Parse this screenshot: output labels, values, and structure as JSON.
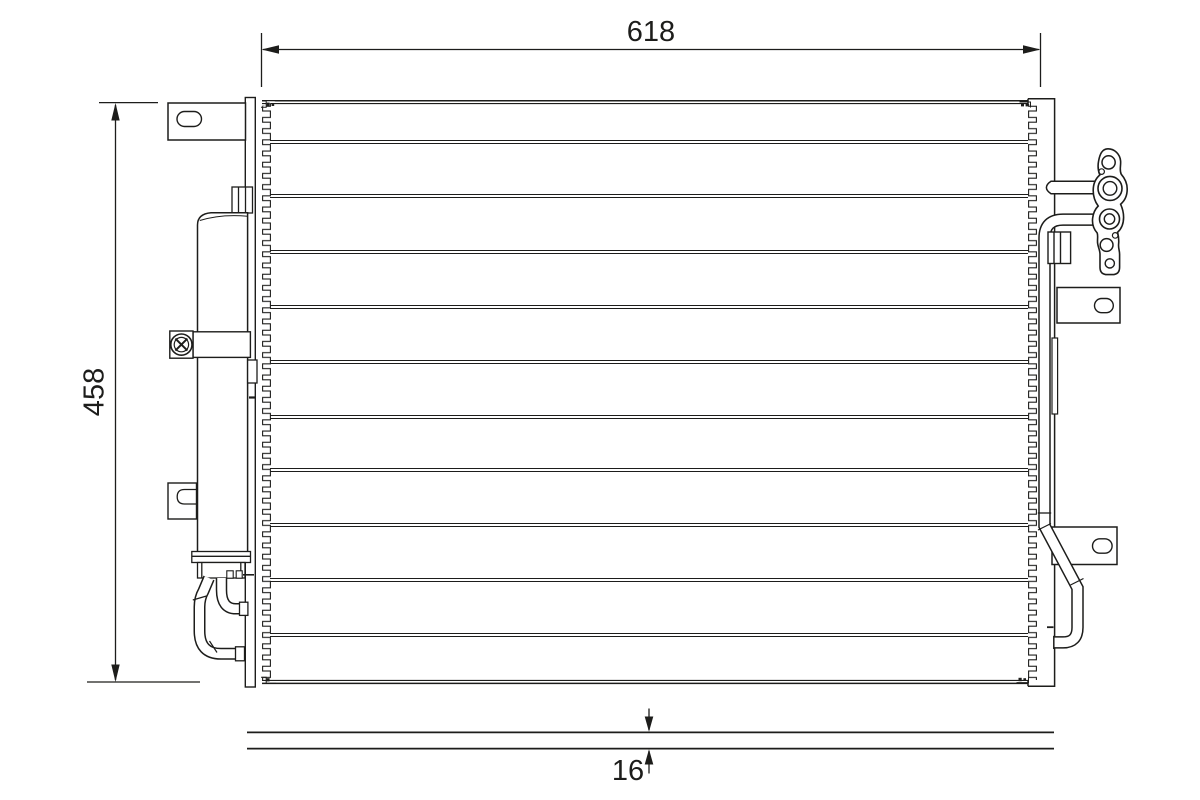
{
  "drawing": {
    "type": "technical-part-drawing",
    "part": "ac-condenser-front-view-with-receiver-drier",
    "colors": {
      "background": "#ffffff",
      "line": "#1d1d1b"
    }
  },
  "annotations": {
    "width_label": "618",
    "height_label": "458",
    "thickness_label": "16"
  }
}
